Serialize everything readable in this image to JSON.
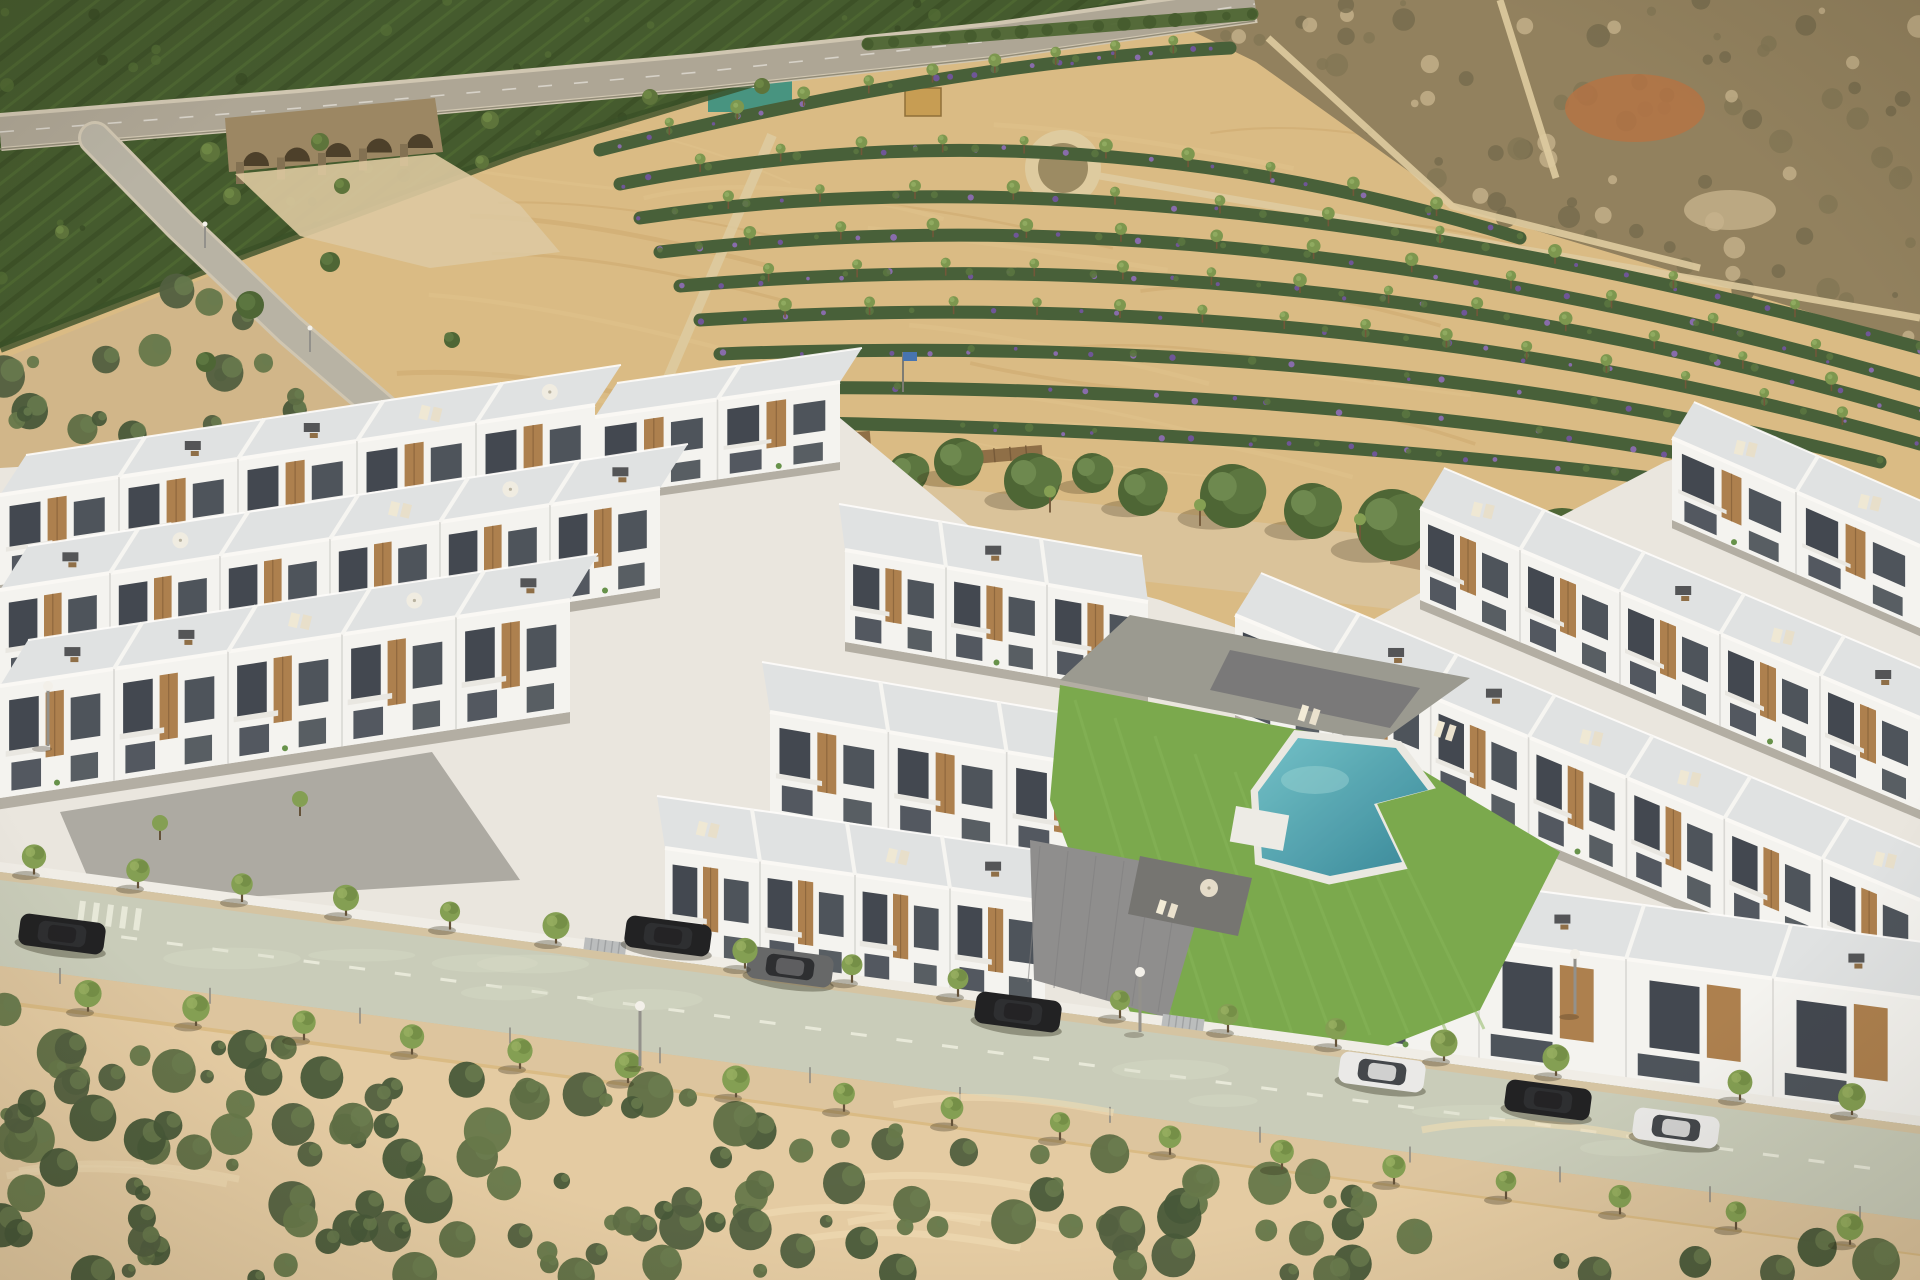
{
  "scene": {
    "description": "Aerial 3D render of a modern white residential complex of terraced villas with rooftop terraces and a communal turquoise pool, fronted by a tree-lined street with parked cars, surrounded by sandy scrubland, a plowed tan field with rows of flowering shrubs, an orchard hillside with a stone arch bridge and dry scrub hills"
  },
  "palette": {
    "base_sand": "#d9ba82",
    "field_light": "#e0c28a",
    "field_streak": "#c9a468",
    "orchard_green": "#3c5527",
    "orchard_stripe": "#2c421d",
    "orchard_light": "#4c6a31",
    "highway": "#aaa494",
    "highway_edge": "#cec6b2",
    "bridge_stone": "#97835f",
    "bridge_arch": "#443823",
    "scrub_ne": "#8d7d5a",
    "scrub_ne_dark": "#6e6547",
    "scrub_ne_pale": "#c3b089",
    "red_patch": "#b06f3f",
    "path_pale": "#ddcb9f",
    "hedge": "#46622e",
    "crop_green": "#3f5a33",
    "crop_purple": "#8a68b8",
    "crop_purple_dark": "#6d4fa1",
    "crop_tree": "#77944a",
    "boulevard_sand": "#d9c299",
    "soil_shadow": "#8a7049",
    "channel_water": "#b7c7a3",
    "pine_dark": "#45602f",
    "pine_mid": "#54713a",
    "pine_light": "#67854a",
    "trunk": "#6b5133",
    "plate": "#e9e7e1",
    "wall_white": "#f4f5f3",
    "wall_shade": "#e4e5e2",
    "roof_pale": "#dfe3e5",
    "roof_line": "#fafaf8",
    "window_dark": "#39414b",
    "window_mid": "#454d57",
    "wood": "#a97c49",
    "wood_dark": "#8a6238",
    "divider": "#d7d8d6",
    "terrace_wall": "#f6f7f5",
    "lawn": "#74a748",
    "lawn_light": "#82b355",
    "pool_light": "#6cc0c8",
    "pool_deep": "#2f8498",
    "coping": "#e9e9e4",
    "pave_gray": "#8a8b8c",
    "pave_dark": "#737476",
    "pave_top": "#96978f",
    "boundary_wall": "#f0efe9",
    "gate": "#b8bcbe",
    "street": "#c7ccba",
    "street_dash": "#eceee2",
    "sidewalk": "#dcc49e",
    "gutter": "#d3c3a2",
    "bush_a": "#55683f",
    "bush_b": "#49593a",
    "bush_c": "#3e5233",
    "bush_d": "#5f7344",
    "sand_bottom": "#e3cba2",
    "car_black": "#17191c",
    "car_gray": "#5f6265",
    "car_white": "#e9eaea",
    "lamp_pole": "#8e8e8a",
    "lamp_head": "#f3f2ec",
    "street_tree": "#7e9c4e",
    "street_tree_dark": "#66843c",
    "flag_blue": "#3e6fb0",
    "pergola_wood": "#8a6a42",
    "container_teal": "#2e8d7d",
    "container_white": "#eceff0",
    "hut_roof": "#c49a4e"
  },
  "orchard": {
    "polygon": [
      [
        0,
        0
      ],
      [
        1155,
        0
      ],
      [
        820,
        62
      ],
      [
        520,
        152
      ],
      [
        250,
        252
      ],
      [
        0,
        348
      ]
    ],
    "stripe_spacing": 26,
    "stripe_angle_deg": -19
  },
  "highway": {
    "pts": [
      [
        0,
        132
      ],
      [
        300,
        108
      ],
      [
        700,
        72
      ],
      [
        1000,
        40
      ],
      [
        1255,
        4
      ]
    ],
    "width": 30
  },
  "bridge": {
    "x0": 225,
    "x1": 435,
    "ytop": 112,
    "ybottom": 172,
    "arches": 5
  },
  "scrub_ne": {
    "polygon": [
      [
        1128,
        0
      ],
      [
        1920,
        0
      ],
      [
        1920,
        345
      ],
      [
        1460,
        208
      ],
      [
        1256,
        62
      ]
    ],
    "paths": [
      [
        [
          1065,
          170
        ],
        [
          1920,
          318
        ]
      ],
      [
        [
          1268,
          38
        ],
        [
          1452,
          206
        ],
        [
          1700,
          268
        ]
      ],
      [
        [
          1500,
          0
        ],
        [
          1556,
          178
        ]
      ]
    ],
    "red_patch": [
      1635,
      108,
      70,
      34
    ],
    "roundabout": {
      "cx": 1063,
      "cy": 168,
      "r": 38
    },
    "hut": [
      905,
      88,
      36,
      28
    ],
    "enclosure": [
      708,
      78,
      84,
      34
    ],
    "container": [
      724,
      66,
      42,
      22
    ]
  },
  "hedge": {
    "p0": [
      868,
      44
    ],
    "p1": [
      1252,
      14
    ]
  },
  "field_path": {
    "p0": [
      650,
      420
    ],
    "p1": [
      772,
      135
    ]
  },
  "crop_rows": [
    {
      "p0": [
        600,
        150
      ],
      "c": [
        950,
        62
      ],
      "p1": [
        1230,
        48
      ]
    },
    {
      "p0": [
        620,
        184
      ],
      "c": [
        1060,
        96
      ],
      "p1": [
        1520,
        238
      ]
    },
    {
      "p0": [
        640,
        218
      ],
      "c": [
        1160,
        140
      ],
      "p1": [
        1920,
        348
      ]
    },
    {
      "p0": [
        660,
        252
      ],
      "c": [
        1240,
        185
      ],
      "p1": [
        1920,
        384
      ]
    },
    {
      "p0": [
        680,
        286
      ],
      "c": [
        1300,
        232
      ],
      "p1": [
        1920,
        414
      ]
    },
    {
      "p0": [
        700,
        320
      ],
      "c": [
        1340,
        280
      ],
      "p1": [
        1920,
        444
      ]
    },
    {
      "p0": [
        720,
        354
      ],
      "c": [
        1360,
        330
      ],
      "p1": [
        1880,
        462
      ]
    },
    {
      "p0": [
        740,
        388
      ],
      "c": [
        1340,
        382
      ],
      "p1": [
        1790,
        474
      ]
    },
    {
      "p0": [
        758,
        422
      ],
      "c": [
        1280,
        430
      ],
      "p1": [
        1700,
        484
      ]
    }
  ],
  "boulevard": {
    "band": [
      [
        540,
        442
      ],
      [
        1920,
        596
      ],
      [
        1920,
        668
      ],
      [
        540,
        514
      ]
    ],
    "soil": [
      [
        1390,
        540
      ],
      [
        1920,
        648
      ],
      [
        1920,
        672
      ],
      [
        1390,
        564
      ]
    ],
    "pines": [
      [
        565,
        468,
        24
      ],
      [
        642,
        454,
        20
      ],
      [
        706,
        468,
        28
      ],
      [
        772,
        452,
        22
      ],
      [
        842,
        468,
        26
      ],
      [
        908,
        478,
        20
      ],
      [
        958,
        468,
        24
      ],
      [
        1032,
        488,
        28
      ],
      [
        1092,
        478,
        20
      ],
      [
        1142,
        498,
        24
      ],
      [
        1232,
        504,
        32
      ],
      [
        1312,
        518,
        28
      ],
      [
        1392,
        534,
        36
      ],
      [
        1472,
        548,
        28
      ],
      [
        1562,
        558,
        40
      ],
      [
        1652,
        578,
        32
      ],
      [
        1735,
        598,
        28
      ],
      [
        1822,
        618,
        24
      ],
      [
        1892,
        638,
        20
      ]
    ],
    "saplings": [
      620,
      760,
      900,
      1050,
      1200,
      1360,
      1520,
      1690,
      1850
    ],
    "flag": [
      903,
      352
    ],
    "pergolas": [
      [
        800,
        437,
        70
      ],
      [
        962,
        452,
        80
      ]
    ]
  },
  "channel": [
    [
      1430,
      545
    ],
    [
      1820,
      663
    ],
    [
      1820,
      690
    ],
    [
      1430,
      572
    ]
  ],
  "complex": {
    "plate": [
      [
        0,
        468
      ],
      [
        840,
        418
      ],
      [
        1010,
        560
      ],
      [
        1160,
        600
      ],
      [
        1310,
        655
      ],
      [
        1500,
        548
      ],
      [
        1665,
        462
      ],
      [
        1740,
        438
      ],
      [
        1920,
        520
      ],
      [
        1920,
        1132
      ],
      [
        0,
        880
      ]
    ],
    "rows": [
      {
        "id": "left-back",
        "x1": 0,
        "y1": 585,
        "x2": 595,
        "y2": 495,
        "h": 90,
        "units": 5,
        "rdx": 26,
        "rdy": -40
      },
      {
        "id": "left-back-2",
        "x1": 595,
        "y1": 497,
        "x2": 840,
        "y2": 462,
        "h": 80,
        "units": 2,
        "rdx": 22,
        "rdy": -34
      },
      {
        "id": "left-mid",
        "x1": 0,
        "y1": 690,
        "x2": 660,
        "y2": 588,
        "h": 100,
        "units": 6,
        "rdx": 28,
        "rdy": -44
      },
      {
        "id": "left-front",
        "x1": 0,
        "y1": 798,
        "x2": 570,
        "y2": 712,
        "h": 112,
        "units": 5,
        "rdx": 28,
        "rdy": -46
      },
      {
        "id": "mid-back",
        "x1": 845,
        "y1": 642,
        "x2": 1148,
        "y2": 694,
        "h": 92,
        "units": 3,
        "rdx": -6,
        "rdy": -46
      },
      {
        "id": "mid-mid",
        "x1": 770,
        "y1": 814,
        "x2": 1125,
        "y2": 874,
        "h": 102,
        "units": 3,
        "rdx": -8,
        "rdy": -50
      },
      {
        "id": "mid-front",
        "x1": 665,
        "y1": 958,
        "x2": 1045,
        "y2": 1012,
        "h": 110,
        "units": 4,
        "rdx": -8,
        "rdy": -52
      },
      {
        "id": "right-inner",
        "x1": 1235,
        "y1": 715,
        "x2": 1920,
        "y2": 1000,
        "h": 100,
        "units": 7,
        "rdx": 26,
        "rdy": -42
      },
      {
        "id": "right-mid",
        "x1": 1420,
        "y1": 600,
        "x2": 1920,
        "y2": 810,
        "h": 92,
        "units": 5,
        "rdx": 24,
        "rdy": -40
      },
      {
        "id": "right-edge",
        "x1": 1672,
        "y1": 520,
        "x2": 1920,
        "y2": 628,
        "h": 82,
        "units": 2,
        "rdx": 22,
        "rdy": -36
      },
      {
        "id": "front-villas",
        "x1": 1332,
        "y1": 1042,
        "x2": 1920,
        "y2": 1120,
        "h": 122,
        "units": 4,
        "rdx": 18,
        "rdy": -54,
        "villa": true
      }
    ],
    "driveway": [
      [
        60,
        812
      ],
      [
        432,
        752
      ],
      [
        520,
        880
      ],
      [
        100,
        906
      ]
    ],
    "garden_strips": [
      [
        [
          40,
          590
        ],
        [
          190,
          568
        ],
        [
          192,
          578
        ],
        [
          42,
          600
        ]
      ],
      [
        [
          260,
          558
        ],
        [
          420,
          534
        ],
        [
          422,
          544
        ],
        [
          262,
          568
        ]
      ],
      [
        [
          120,
          712
        ],
        [
          300,
          685
        ],
        [
          302,
          697
        ],
        [
          122,
          724
        ]
      ],
      [
        [
          1128,
          756
        ],
        [
          1186,
          766
        ],
        [
          1183,
          778
        ],
        [
          1125,
          768
        ]
      ]
    ],
    "courtyard_top": [
      [
        1130,
        615
      ],
      [
        1470,
        678
      ],
      [
        1380,
        742
      ],
      [
        1060,
        680
      ]
    ],
    "courtyard_top_deck": [
      [
        1230,
        650
      ],
      [
        1420,
        688
      ],
      [
        1390,
        728
      ],
      [
        1210,
        690
      ]
    ],
    "lawn": [
      [
        1060,
        685
      ],
      [
        1380,
        745
      ],
      [
        1560,
        852
      ],
      [
        1480,
        1010
      ],
      [
        1300,
        1080
      ],
      [
        1130,
        1012
      ],
      [
        1050,
        800
      ]
    ],
    "entrance_pave": [
      [
        1030,
        840
      ],
      [
        1210,
        874
      ],
      [
        1168,
        1018
      ],
      [
        1034,
        980
      ]
    ],
    "pool_deck": [
      [
        1140,
        856
      ],
      [
        1252,
        878
      ],
      [
        1238,
        936
      ],
      [
        1128,
        914
      ]
    ],
    "pool": [
      [
        1298,
        738
      ],
      [
        1396,
        748
      ],
      [
        1428,
        790
      ],
      [
        1374,
        804
      ],
      [
        1402,
        862
      ],
      [
        1330,
        876
      ],
      [
        1262,
        858
      ],
      [
        1258,
        792
      ]
    ],
    "pool_pad": [
      1236,
      806,
      54,
      36,
      10
    ],
    "loungers": [
      [
        1300,
        712,
        16
      ],
      [
        1436,
        728,
        16
      ],
      [
        1158,
        906,
        14
      ]
    ],
    "wall": {
      "p0": [
        0,
        862
      ],
      "p1": [
        1920,
        1116
      ],
      "w": 10,
      "gates": [
        585,
        1163
      ]
    }
  },
  "street": {
    "top": [
      [
        0,
        872
      ],
      [
        1920,
        1126
      ]
    ],
    "width": 94,
    "sidewalk_w": 34,
    "crosswalk_x": 80,
    "trees_top": [
      34,
      138,
      242,
      346,
      450,
      556,
      745,
      852,
      958,
      1120,
      1228,
      1336,
      1444,
      1556,
      1740,
      1852
    ],
    "trees_bottom": [
      88,
      196,
      304,
      412,
      520,
      628,
      736,
      844,
      952,
      1060,
      1170,
      1282,
      1394,
      1506,
      1620,
      1736,
      1850
    ],
    "posts_step": 150
  },
  "left_road": {
    "pts": [
      [
        95,
        138
      ],
      [
        180,
        225
      ],
      [
        290,
        330
      ],
      [
        400,
        425
      ],
      [
        470,
        462
      ],
      [
        540,
        480
      ]
    ],
    "width": 28,
    "lamps": [
      [
        205,
        248
      ],
      [
        310,
        352
      ],
      [
        420,
        438
      ]
    ],
    "trees": [
      [
        250,
        305,
        14
      ],
      [
        330,
        262,
        10
      ],
      [
        206,
        362,
        10
      ],
      [
        452,
        340,
        8
      ]
    ]
  },
  "highway_trees": [
    [
      210,
      152,
      10
    ],
    [
      320,
      142,
      9
    ],
    [
      490,
      120,
      9
    ],
    [
      650,
      97,
      8
    ],
    [
      762,
      86,
      8
    ],
    [
      120,
      176,
      8
    ],
    [
      232,
      196,
      9
    ],
    [
      342,
      186,
      8
    ],
    [
      62,
      232,
      7
    ],
    [
      482,
      162,
      7
    ]
  ],
  "cars": [
    {
      "x": 62,
      "y": 934,
      "c": "car_black"
    },
    {
      "x": 668,
      "y": 936,
      "c": "car_black"
    },
    {
      "x": 790,
      "y": 967,
      "c": "car_gray"
    },
    {
      "x": 1018,
      "y": 1012,
      "c": "car_black"
    },
    {
      "x": 1382,
      "y": 1072,
      "c": "car_white"
    },
    {
      "x": 1548,
      "y": 1100,
      "c": "car_black"
    },
    {
      "x": 1676,
      "y": 1128,
      "c": "car_white"
    }
  ],
  "lamps": [
    [
      48,
      746
    ],
    [
      640,
      1066
    ],
    [
      1575,
      1014
    ],
    [
      1140,
      1032
    ]
  ],
  "scrub_sw": {
    "polygon": [
      [
        0,
        360
      ],
      [
        230,
        268
      ],
      [
        330,
        345
      ],
      [
        420,
        430
      ],
      [
        470,
        520
      ],
      [
        430,
        585
      ],
      [
        300,
        640
      ],
      [
        0,
        730
      ]
    ],
    "count": 90
  },
  "scrub_bottom": {
    "polygon": [
      [
        0,
        1004
      ],
      [
        1920,
        1256
      ],
      [
        1920,
        1280
      ],
      [
        0,
        1280
      ]
    ],
    "count": 150
  },
  "seed": 7
}
